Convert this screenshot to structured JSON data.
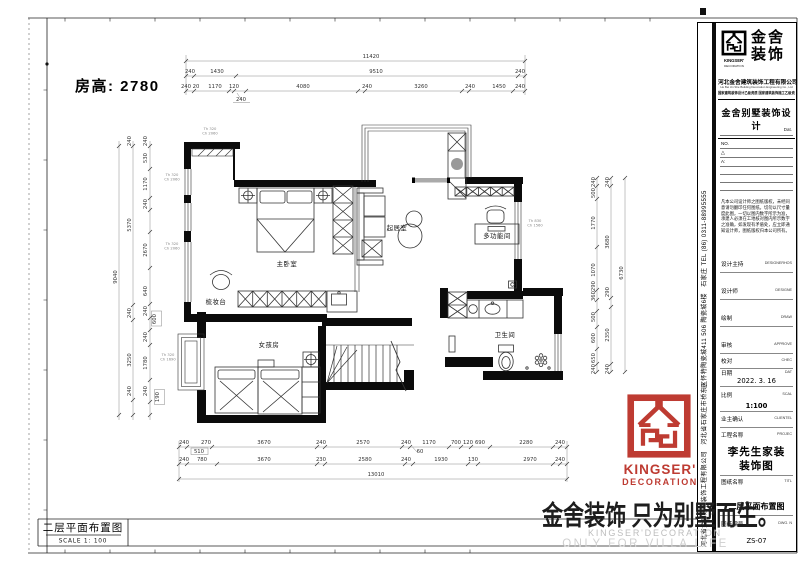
{
  "sheet": {
    "room_height": "房高: 2780",
    "scale_box": {
      "title": "二层平面布置图",
      "scale": "SCALE 1: 100"
    }
  },
  "plan": {
    "room_labels": [
      {
        "x": 287,
        "y": 266,
        "t": "主卧室"
      },
      {
        "x": 397,
        "y": 230,
        "t": "起居室"
      },
      {
        "x": 497,
        "y": 238,
        "t": "多功能间"
      },
      {
        "x": 505,
        "y": 337,
        "t": "卫生间"
      },
      {
        "x": 269,
        "y": 347,
        "t": "女孩房"
      },
      {
        "x": 216,
        "y": 304,
        "t": "梳妆台"
      }
    ],
    "window_tags": [
      {
        "x": 172,
        "y": 176,
        "lines": [
          "Th 320",
          "Ch 2060"
        ]
      },
      {
        "x": 172,
        "y": 245,
        "lines": [
          "Th 320",
          "Ch 2060"
        ]
      },
      {
        "x": 168,
        "y": 356,
        "lines": [
          "Th 320",
          "Ch 1690"
        ]
      },
      {
        "x": 210,
        "y": 130,
        "lines": [
          "Th 320",
          "Ch 2060"
        ]
      },
      {
        "x": 535,
        "y": 222,
        "lines": [
          "Th 830",
          "Ch 1560"
        ]
      }
    ],
    "dims_top": [
      {
        "x": 371,
        "y": 58,
        "t": "11420"
      },
      {
        "x": 190,
        "y": 73,
        "t": "240"
      },
      {
        "x": 217,
        "y": 73,
        "t": "1430"
      },
      {
        "x": 376,
        "y": 73,
        "t": "9510"
      },
      {
        "x": 520,
        "y": 73,
        "t": "240"
      },
      {
        "x": 186,
        "y": 88,
        "t": "240"
      },
      {
        "x": 196,
        "y": 88,
        "t": "20"
      },
      {
        "x": 215,
        "y": 88,
        "t": "1170"
      },
      {
        "x": 234,
        "y": 88,
        "t": "120"
      },
      {
        "x": 303,
        "y": 88,
        "t": "4080"
      },
      {
        "x": 367,
        "y": 88,
        "t": "240"
      },
      {
        "x": 421,
        "y": 88,
        "t": "3260"
      },
      {
        "x": 470,
        "y": 88,
        "t": "240"
      },
      {
        "x": 499,
        "y": 88,
        "t": "1450"
      },
      {
        "x": 520,
        "y": 88,
        "t": "240"
      },
      {
        "x": 241,
        "y": 101,
        "t": "240"
      }
    ],
    "dims_bottom": [
      {
        "x": 184,
        "y": 444,
        "t": "240"
      },
      {
        "x": 206,
        "y": 444,
        "t": "270"
      },
      {
        "x": 264,
        "y": 444,
        "t": "3670"
      },
      {
        "x": 321,
        "y": 444,
        "t": "240"
      },
      {
        "x": 363,
        "y": 444,
        "t": "2570"
      },
      {
        "x": 406,
        "y": 444,
        "t": "240"
      },
      {
        "x": 429,
        "y": 444,
        "t": "1170"
      },
      {
        "x": 456,
        "y": 444,
        "t": "700"
      },
      {
        "x": 468,
        "y": 444,
        "t": "120"
      },
      {
        "x": 480,
        "y": 444,
        "t": "690"
      },
      {
        "x": 526,
        "y": 444,
        "t": "2280"
      },
      {
        "x": 560,
        "y": 444,
        "t": "240"
      },
      {
        "x": 199,
        "y": 453,
        "t": "510"
      },
      {
        "x": 420,
        "y": 453,
        "t": "60"
      },
      {
        "x": 184,
        "y": 461,
        "t": "240"
      },
      {
        "x": 202,
        "y": 461,
        "t": "780"
      },
      {
        "x": 264,
        "y": 461,
        "t": "3670"
      },
      {
        "x": 321,
        "y": 461,
        "t": "230"
      },
      {
        "x": 365,
        "y": 461,
        "t": "2580"
      },
      {
        "x": 406,
        "y": 461,
        "t": "240"
      },
      {
        "x": 441,
        "y": 461,
        "t": "1930"
      },
      {
        "x": 473,
        "y": 461,
        "t": "130"
      },
      {
        "x": 530,
        "y": 461,
        "t": "2970"
      },
      {
        "x": 560,
        "y": 461,
        "t": "240"
      },
      {
        "x": 376,
        "y": 476,
        "t": "13010"
      }
    ],
    "dims_left": [
      {
        "x": 147,
        "y": 141,
        "t": "240",
        "r": 1
      },
      {
        "x": 147,
        "y": 158,
        "t": "530",
        "r": 1
      },
      {
        "x": 147,
        "y": 184,
        "t": "1170",
        "r": 1
      },
      {
        "x": 147,
        "y": 204,
        "t": "240",
        "r": 1
      },
      {
        "x": 147,
        "y": 250,
        "t": "2670",
        "r": 1
      },
      {
        "x": 147,
        "y": 291,
        "t": "640",
        "r": 1
      },
      {
        "x": 147,
        "y": 311,
        "t": "240",
        "r": 1
      },
      {
        "x": 156,
        "y": 319,
        "t": "600",
        "r": 1
      },
      {
        "x": 147,
        "y": 337,
        "t": "240",
        "r": 1
      },
      {
        "x": 147,
        "y": 363,
        "t": "1780",
        "r": 1
      },
      {
        "x": 147,
        "y": 391,
        "t": "240",
        "r": 1
      },
      {
        "x": 159,
        "y": 397,
        "t": "190",
        "r": 1
      },
      {
        "x": 131,
        "y": 141,
        "t": "240",
        "r": 1
      },
      {
        "x": 131,
        "y": 225,
        "t": "5370",
        "r": 1
      },
      {
        "x": 131,
        "y": 313,
        "t": "240",
        "r": 1
      },
      {
        "x": 131,
        "y": 360,
        "t": "3250",
        "r": 1
      },
      {
        "x": 131,
        "y": 391,
        "t": "240",
        "r": 1
      },
      {
        "x": 117,
        "y": 277,
        "t": "9040",
        "r": 1
      }
    ],
    "dims_right": [
      {
        "x": 595,
        "y": 182,
        "t": "240",
        "r": 1
      },
      {
        "x": 595,
        "y": 193,
        "t": "500",
        "r": 1
      },
      {
        "x": 595,
        "y": 223,
        "t": "1770",
        "r": 1
      },
      {
        "x": 595,
        "y": 270,
        "t": "1070",
        "r": 1
      },
      {
        "x": 595,
        "y": 286,
        "t": "290",
        "r": 1
      },
      {
        "x": 595,
        "y": 296,
        "t": "360",
        "r": 1
      },
      {
        "x": 595,
        "y": 317,
        "t": "500",
        "r": 1
      },
      {
        "x": 595,
        "y": 338,
        "t": "600",
        "r": 1
      },
      {
        "x": 595,
        "y": 358,
        "t": "650",
        "r": 1
      },
      {
        "x": 595,
        "y": 369,
        "t": "240",
        "r": 1
      },
      {
        "x": 609,
        "y": 182,
        "t": "240",
        "r": 1
      },
      {
        "x": 609,
        "y": 242,
        "t": "3680",
        "r": 1
      },
      {
        "x": 609,
        "y": 292,
        "t": "290",
        "r": 1
      },
      {
        "x": 609,
        "y": 335,
        "t": "2350",
        "r": 1
      },
      {
        "x": 609,
        "y": 369,
        "t": "240",
        "r": 1
      },
      {
        "x": 623,
        "y": 273,
        "t": "6730",
        "r": 1
      }
    ]
  },
  "titleblock": {
    "brand": {
      "cn1": "金舍",
      "cn2": "装饰",
      "en1": "KINGSER'",
      "en2": "DECORATION"
    },
    "company": "河北金舍建筑装饰工程有限公司",
    "company_en": "He Bei Jin She Building Decoration Engineering Co., Ltd",
    "cert_line": "国家建筑装饰设计乙级资质 国家建筑装饰施工乙级资质",
    "product": "金舍别墅装饰设计",
    "dat_label": "Dat.",
    "no_label": "NO.",
    "rev_tri": "△",
    "rev_a": "A:",
    "disclaimer": "凡本公司设计师之图纸版权，未经同意请勿翻印任何图纸。切勿以尺寸量度此图，一切以图内数字所示为准，承建人必须在工地核对图内所示数字之准确，如发现有矛盾处，应立即通知设计师，图纸版权归本公司所有。",
    "fields": [
      {
        "cn": "设计主持",
        "en": "DESIGNERHOS",
        "v": ""
      },
      {
        "cn": "设计师",
        "en": "DESIGNE",
        "v": ""
      },
      {
        "cn": "绘制",
        "en": "DRAW",
        "v": ""
      },
      {
        "cn": "审核",
        "en": "APPROVE",
        "v": ""
      },
      {
        "cn": "校对",
        "en": "CHEC",
        "v": ""
      },
      {
        "cn": "日期",
        "en": "DAT",
        "v": "2022. 3. 16"
      },
      {
        "cn": "比例",
        "en": "SCAL",
        "v": "1:100"
      },
      {
        "cn": "业主确认",
        "en": "CLIENTEL",
        "v": ""
      },
      {
        "cn": "工程名称",
        "en": "PROJEC",
        "v1": "李先生家装",
        "v2": "装饰图"
      },
      {
        "cn": "图纸名称",
        "en": "TITL",
        "v": "二层平面布置图"
      },
      {
        "cn": "图纸编号",
        "en": "DWG. N",
        "v": "ZS-07"
      }
    ],
    "contact_vertical": "河北省金舍建筑装饰工程有限公司　河北省石家庄市桥东区怀特陶瓷城411 506 陶瓷城6楼　石家庄 TEL (86) 0311-88995555"
  },
  "red_logo": {
    "name": "KINGSER'",
    "sub": "DECORATION",
    "reg": "®"
  },
  "watermark": {
    "main": "金舍装饰 只为别墅而生。",
    "sub1": "KINGSER'DECORATION",
    "sub2": "ONLY FOR VILLA LIFE"
  }
}
